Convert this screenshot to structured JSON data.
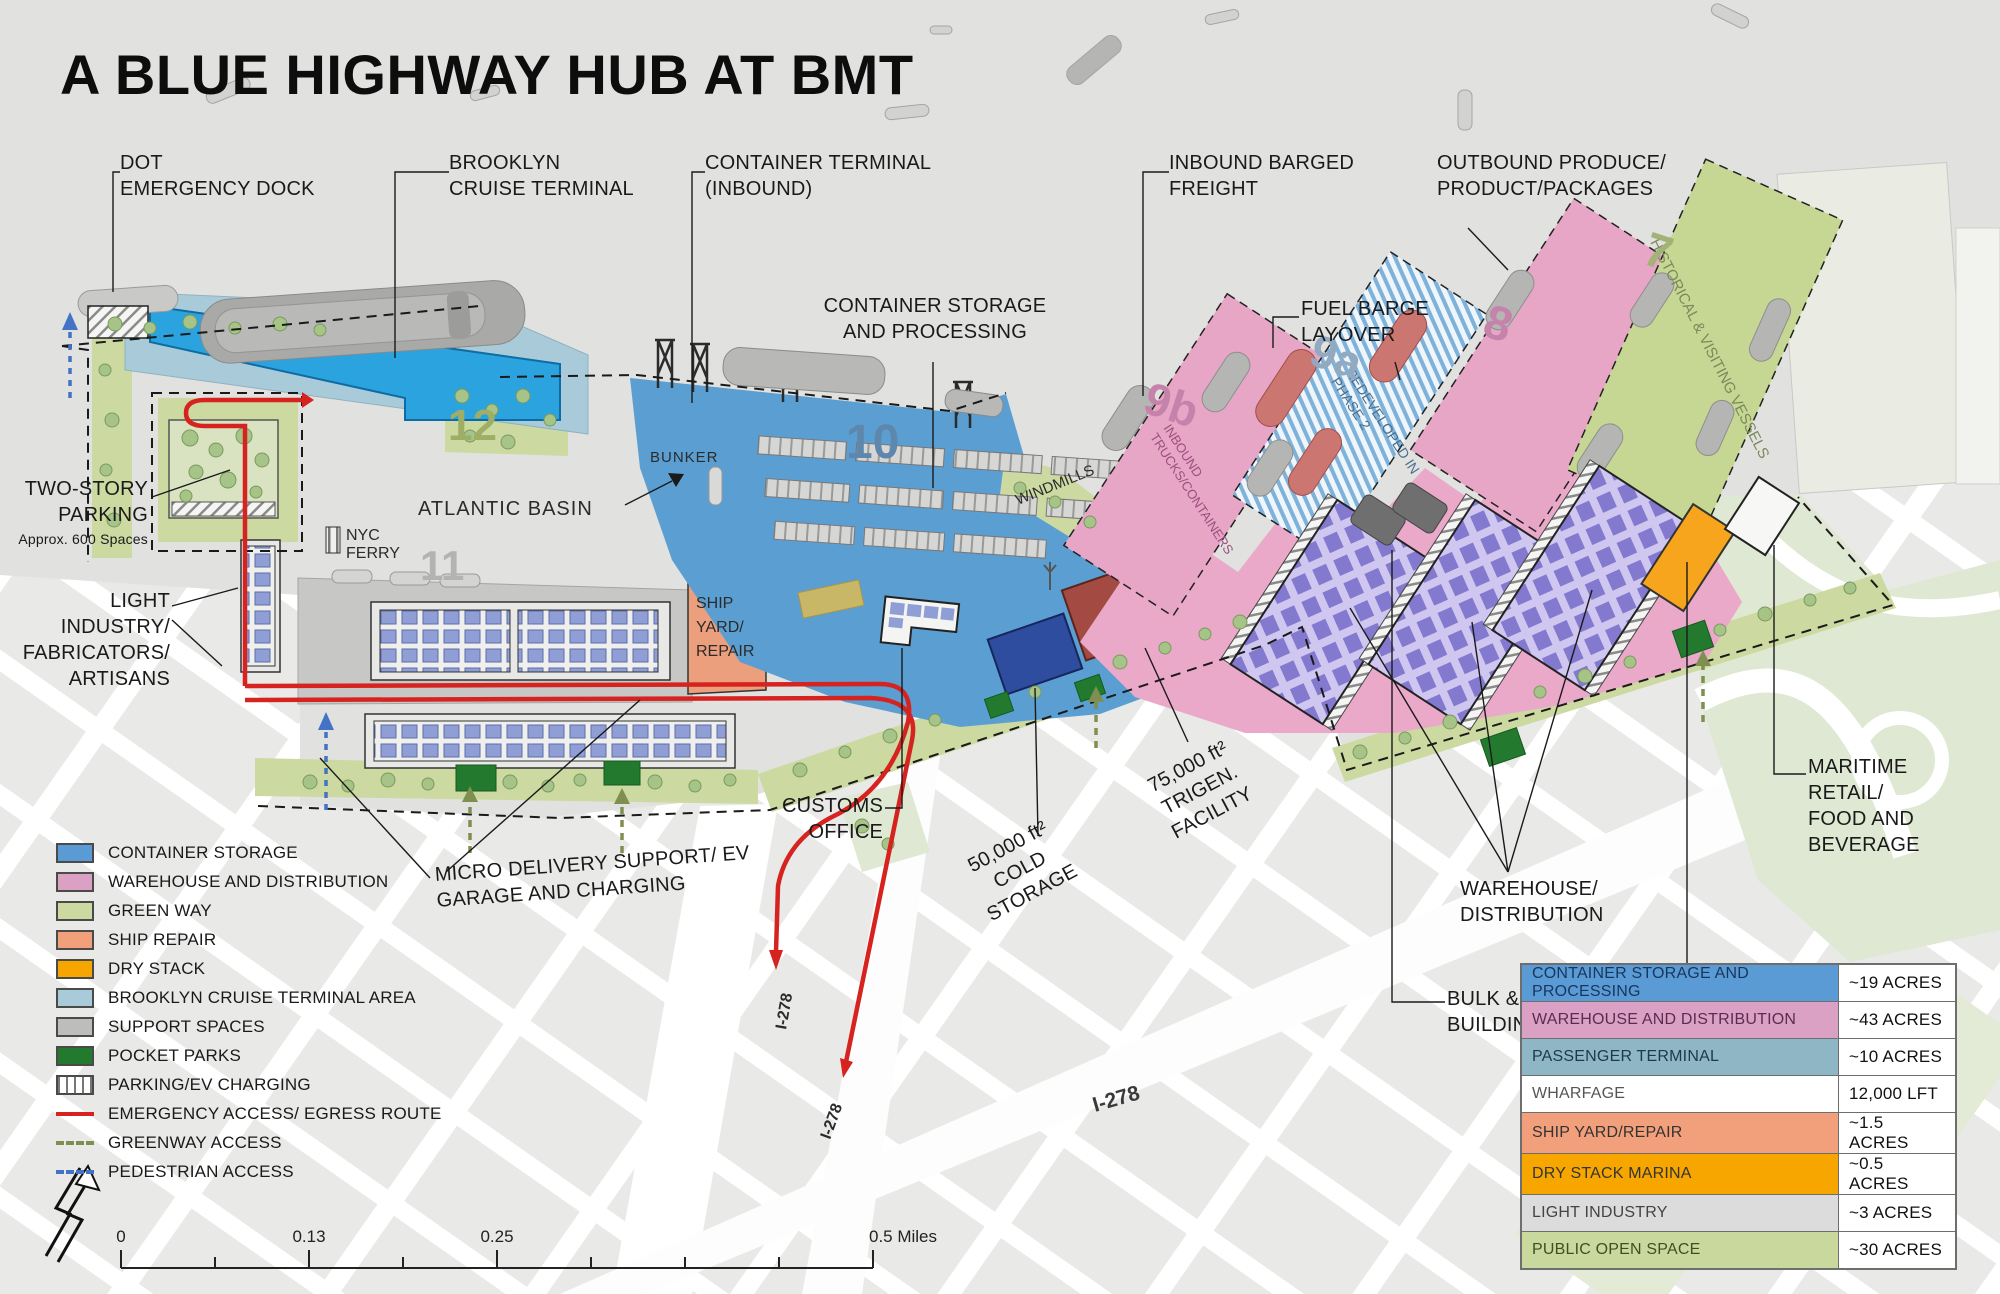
{
  "title": "A BLUE HIGHWAY HUB AT BMT",
  "callouts": {
    "dot_dock": "DOT\nEMERGENCY DOCK",
    "cruise_terminal": "BROOKLYN\nCRUISE TERMINAL",
    "container_terminal": "CONTAINER TERMINAL\n(INBOUND)",
    "inbound_freight": "INBOUND BARGED\nFREIGHT",
    "outbound_produce": "OUTBOUND PRODUCE/\nPRODUCT/PACKAGES",
    "container_storage": "CONTAINER STORAGE\nAND PROCESSING",
    "fuel_barge": "FUEL BARGE\nLAYOVER",
    "two_story_parking": "TWO-STORY\nPARKING",
    "parking_note": "Approx. 600 Spaces",
    "light_industry": "LIGHT INDUSTRY/\nFABRICATORS/\nARTISANS",
    "micro_delivery": "MICRO DELIVERY SUPPORT/ EV\nGARAGE AND CHARGING",
    "customs_office": "CUSTOMS\nOFFICE",
    "cold_storage": "50,000 ft²\nCOLD\nSTORAGE",
    "trigen": "75,000 ft²\nTRIGEN.\nFACILITY",
    "warehouse_distribution": "WAREHOUSE/\nDISTRIBUTION",
    "bulk_materials": "BULK &\nBUILDING MATERIALS",
    "dry_stack_marina": "DRY STACK\nMARINA/REPAIR",
    "maritime_retail": "MARITIME\nRETAIL/\nFOOD AND\nBEVERAGE"
  },
  "map": {
    "atlantic_basin": "ATLANTIC BASIN",
    "bunker": "BUNKER",
    "windmills": "WINDMILLS",
    "nyc_ferry_lines": [
      "NYC",
      "FERRY"
    ],
    "ship_yard_lines": [
      "SHIP",
      "YARD/",
      "REPAIR"
    ],
    "inbound_trucks_lines": [
      "INBOUND",
      "TRUCKS/CONTAINERS"
    ],
    "redeveloped_lines": [
      "REDEVELOPED IN",
      "PHASE 2"
    ],
    "historical_vessels": "HISTORICAL & VISITING VESSELS",
    "zone_12": "12",
    "zone_11": "11",
    "zone_10": "10",
    "zone_9b": "9b",
    "zone_9a": "9a",
    "zone_8": "8",
    "zone_7": "7",
    "i278_a": "I-278",
    "i278_b": "I-278",
    "i278_c": "I-278"
  },
  "legend": {
    "items": [
      {
        "label": "CONTAINER STORAGE",
        "swatch": "background:#5B9BD5"
      },
      {
        "label": "WAREHOUSE AND DISTRIBUTION",
        "swatch": "background:#DBA1C5"
      },
      {
        "label": "GREEN WAY",
        "swatch": "background:#CCD9A0"
      },
      {
        "label": "SHIP REPAIR",
        "swatch": "background:#F2A07B"
      },
      {
        "label": "DRY STACK",
        "swatch": "background:#F7A600"
      },
      {
        "label": "BROOKLYN CRUISE TERMINAL AREA",
        "swatch": "background:#A9CBD9"
      },
      {
        "label": "SUPPORT SPACES",
        "swatch": "background:#BDBDBC"
      },
      {
        "label": "POCKET PARKS",
        "swatch": "background:#237A2F"
      },
      {
        "label": "PARKING/EV CHARGING",
        "swatch": ""
      },
      {
        "label": "EMERGENCY ACCESS/ EGRESS ROUTE",
        "swatch": ""
      },
      {
        "label": "GREENWAY ACCESS",
        "swatch": ""
      },
      {
        "label": "PEDESTRIAN ACCESS",
        "swatch": ""
      }
    ]
  },
  "table": {
    "rows": [
      {
        "label": "CONTAINER STORAGE AND PROCESSING",
        "value": "~19 ACRES",
        "style": "background:#5B9BD5;color:#17365D"
      },
      {
        "label": "WAREHOUSE AND DISTRIBUTION",
        "value": "~43 ACRES",
        "style": "background:#DBA1C5;color:#5A2D4F"
      },
      {
        "label": "PASSENGER TERMINAL",
        "value": "~10 ACRES",
        "style": "background:#8FB6C4;color:#1C3A4A"
      },
      {
        "label": "WHARFAGE",
        "value": "12,000 LFT",
        "style": "background:#FFFFFF;color:#555555"
      },
      {
        "label": "SHIP YARD/REPAIR",
        "value": "~1.5 ACRES",
        "style": "background:#F2A07B;color:#333333"
      },
      {
        "label": "DRY STACK MARINA",
        "value": "~0.5 ACRES",
        "style": "background:#F7A600;color:#333333"
      },
      {
        "label": "LIGHT INDUSTRY",
        "value": "~3 ACRES",
        "style": "background:#DCDCDC;color:#444444"
      },
      {
        "label": "PUBLIC OPEN SPACE",
        "value": "~30 ACRES",
        "style": "background:#C9D89C;color:#3F4F24"
      }
    ]
  },
  "scale": {
    "t0": "0",
    "t1": "0.13",
    "t2": "0.25",
    "t3": "0.5 Miles"
  },
  "colors": {
    "container_storage": "#5B9BD5",
    "warehouse": "#DBA1C5",
    "greenway": "#CCD9A0",
    "ship_repair": "#F2A07B",
    "dry_stack": "#F7A600",
    "cruise_area": "#A9CBD9",
    "support": "#BDBDBC",
    "pocket_park": "#237A2F",
    "emergency_route": "#D6231F",
    "greenway_access": "#7F8F4F",
    "pedestrian_access": "#4472C4"
  }
}
